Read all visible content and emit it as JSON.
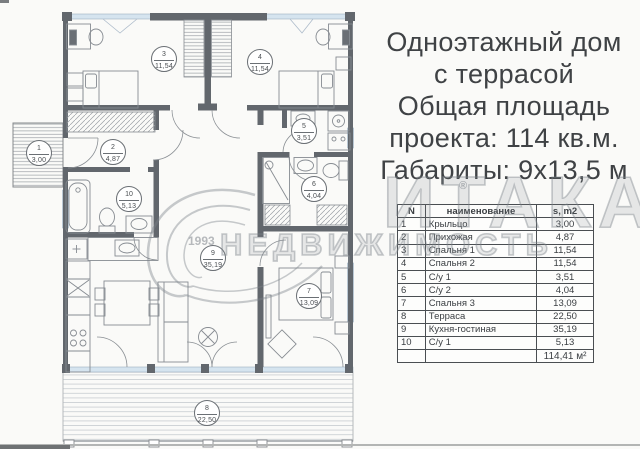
{
  "title": {
    "lines": [
      "Одноэтажный дом",
      "с террасой",
      "Общая площадь",
      "проекта: 114 кв.м.",
      "Габариты: 9х13,5 м"
    ]
  },
  "table": {
    "header": {
      "num": "N",
      "name": "наименование",
      "area": "s, m2"
    },
    "rows": [
      {
        "num": "1",
        "name": "Крыльцо",
        "area": "3,00"
      },
      {
        "num": "2",
        "name": "Прихожая",
        "area": "4,87"
      },
      {
        "num": "3",
        "name": "Спальня 1",
        "area": "11,54"
      },
      {
        "num": "4",
        "name": "Спальня 2",
        "area": "11,54"
      },
      {
        "num": "5",
        "name": "С/у 1",
        "area": "3,51"
      },
      {
        "num": "6",
        "name": "С/у 2",
        "area": "4,04"
      },
      {
        "num": "7",
        "name": "Спальня 3",
        "area": "13,09"
      },
      {
        "num": "8",
        "name": "Терраса",
        "area": "22,50"
      },
      {
        "num": "9",
        "name": "Кухня-гостиная",
        "area": "35,19"
      },
      {
        "num": "10",
        "name": "С/у 1",
        "area": "5,13"
      }
    ],
    "total": "114,41 м²"
  },
  "plan": {
    "rooms": [
      {
        "num": "1",
        "area": "3,00"
      },
      {
        "num": "2",
        "area": "4,87"
      },
      {
        "num": "3",
        "area": "11,54"
      },
      {
        "num": "4",
        "area": "11,54"
      },
      {
        "num": "5",
        "area": "3,51"
      },
      {
        "num": "6",
        "area": "4,04"
      },
      {
        "num": "7",
        "area": "13,09"
      },
      {
        "num": "8",
        "area": "22,50"
      },
      {
        "num": "9",
        "area": "35,19"
      },
      {
        "num": "10",
        "area": "5,13"
      }
    ]
  },
  "watermark": {
    "brand": "ИТАКА",
    "reg": "®",
    "year": "1993",
    "word": "НЕДВИЖИМОСТЬ"
  },
  "colors": {
    "wall": "#62676d",
    "window": "#d5e4ef",
    "text": "#3f4245",
    "table_border": "#4a4e52"
  }
}
